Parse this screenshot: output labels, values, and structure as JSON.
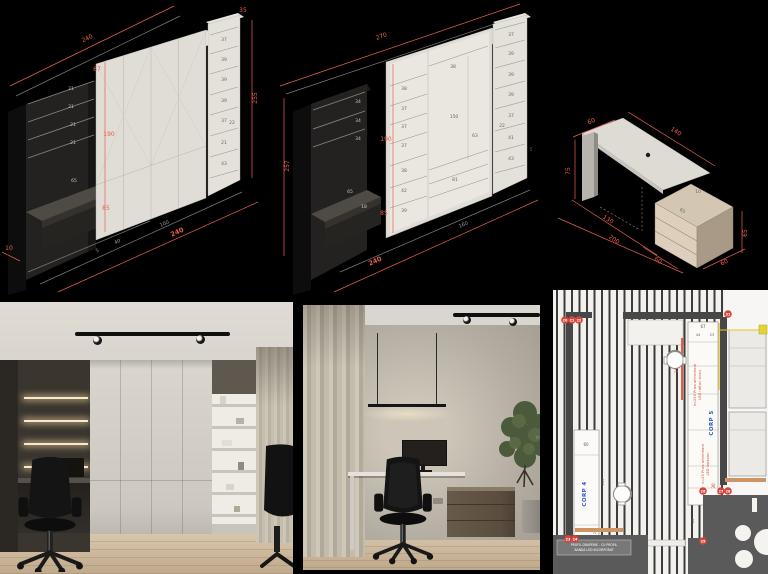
{
  "colors": {
    "dim_red": "#e8604e",
    "dim_gray": "#9a9a9a",
    "label_blue": "#3054c8",
    "note_red": "#d94f43",
    "marker_red": "#d6453a",
    "led_yellow": "#e3d435",
    "curtain_orange": "#cf9465"
  },
  "drawing1": {
    "top_length": "240",
    "top_depth_small": "35",
    "right_height": "255",
    "door_depth": "67",
    "door_height": "190",
    "base_height": "85",
    "shelf_gaps": [
      "21",
      "21",
      "21",
      "21"
    ],
    "desk_depth": "65",
    "col_shelves": [
      "37",
      "39",
      "39",
      "39",
      "37",
      "21",
      "43"
    ],
    "col_extra": "22",
    "bottom_red": "240",
    "bottom_gray_a": "100",
    "bottom_gray_b": "40",
    "bottom_gray_c": "5",
    "corner_left": "10"
  },
  "drawing2": {
    "top_length": "270",
    "left_height": "257",
    "door_height": "190",
    "base_height": "85",
    "dark_gaps": [
      "34",
      "34",
      "34"
    ],
    "desk_depth": "65",
    "desk_offset": "18",
    "col1": [
      "38",
      "37",
      "37",
      "37",
      "38",
      "42",
      "39"
    ],
    "mid_top": "38",
    "niche_h": "150",
    "niche_w": "63",
    "drawers": "81",
    "col3": [
      "37",
      "39",
      "39",
      "39",
      "37",
      "41",
      "43"
    ],
    "col3_extra": "22",
    "col3_small": "5",
    "bottom_gray": "160",
    "bottom_red": "240"
  },
  "drawing3": {
    "depth": "60",
    "length": "140",
    "height": "75",
    "gap": "10",
    "unit_width": "65",
    "unit_height": "65",
    "unit_depth": "60",
    "unit_left": "60",
    "span_a": "130",
    "span_b": "200"
  },
  "plan": {
    "dim_67": "67",
    "dim_44": "44",
    "dim_23": "23",
    "dim_150": "150",
    "dim_60": "60",
    "dim_200": "200",
    "dim_29": "29",
    "dim_28": "28",
    "dim_30": "30",
    "corp4": "CORP 4",
    "corp5": "CORP 5",
    "note_birou_1": "h=220 Priza alimentare",
    "note_birou_2": "LED rafturi birou",
    "note_dulap_1": "h=25 Priza alimentare",
    "note_dulap_2": "LED dulapuri",
    "profil_1": "PROFIL DRAPERIE - CU PROFIL",
    "profil_2": "BANDA LED INCORPORAT",
    "markers": {
      "m20": "20",
      "m21": "21",
      "m22": "22",
      "m23": "23",
      "m24": "24",
      "m26": "26",
      "m27": "27",
      "m28": "28",
      "m29": "29",
      "m31": "31"
    }
  }
}
